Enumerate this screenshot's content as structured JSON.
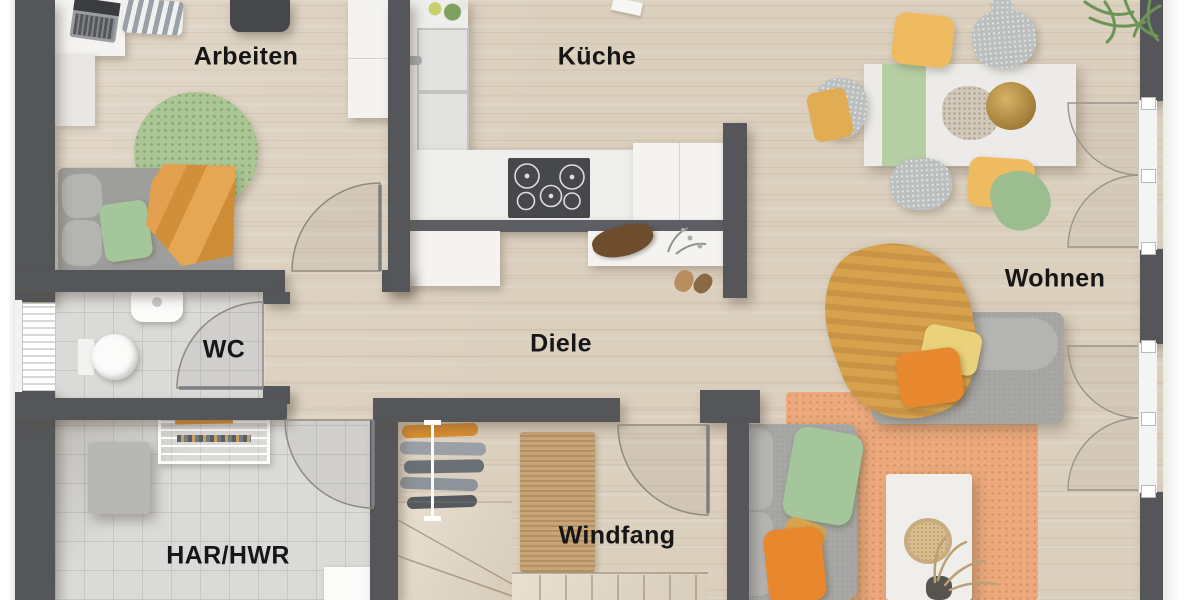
{
  "meta": {
    "type": "floor-plan-top-view",
    "language": "de"
  },
  "rooms": {
    "arbeiten": {
      "label": "Arbeiten"
    },
    "kueche": {
      "label": "Küche"
    },
    "wc": {
      "label": "WC"
    },
    "diele": {
      "label": "Diele"
    },
    "wohnen": {
      "label": "Wohnen"
    },
    "har_hwr": {
      "label": "HAR/HWR"
    },
    "windfang": {
      "label": "Windfang"
    }
  },
  "palette": {
    "wall": "#54565a",
    "wood_floor": "#dbcfbe",
    "tile_floor": "#dadad8",
    "accent_orange": "#e8872e",
    "accent_mustard": "#d9a44f",
    "accent_yellow_chair": "#eebb60",
    "accent_green": "#a5c69b",
    "rug_orange": "#eba97d",
    "rug_green": "#abc595",
    "doormat_tan": "#c8a478",
    "counter_white": "#f4f3f1",
    "cooktop_dark": "#46484c"
  }
}
